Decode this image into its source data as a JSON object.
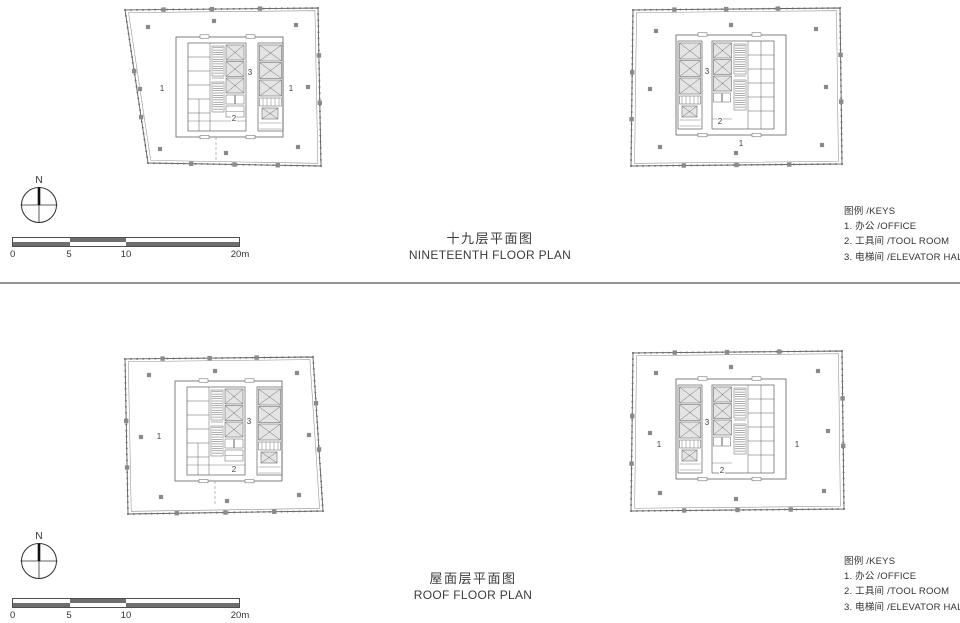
{
  "colors": {
    "background": "#ffffff",
    "ink": "#3b3b3b",
    "drawing_line": "#5f5f5f",
    "column_gray": "#8a8a8a",
    "elevator_fill": "#e4e4e4",
    "scale_dark": "#6e6e6e",
    "divider": "#949494"
  },
  "north": {
    "label": "N"
  },
  "scalebar": {
    "labels": [
      "0",
      "5",
      "10",
      "20m"
    ]
  },
  "sections": [
    {
      "name": "nineteenth-floor",
      "title_zh": "十九层平面图",
      "title_en": "NINETEENTH FLOOR PLAN",
      "legend": {
        "header": "图例 /KEYS",
        "items": [
          "1. 办公 /OFFICE",
          "2. 工具间 /TOOL ROOM",
          "3. 电梯间 /ELEVATOR HALL"
        ]
      },
      "plans": [
        {
          "name": "nineteenth-floor-plan-left",
          "room_labels": [
            {
              "value": "1",
              "meaning": "office",
              "x": 48,
              "y": 88
            },
            {
              "value": "3",
              "meaning": "elevator-hall",
              "x": 136,
              "y": 72
            },
            {
              "value": "1",
              "meaning": "office",
              "x": 177,
              "y": 88
            },
            {
              "value": "2",
              "meaning": "tool-room",
              "x": 120,
              "y": 118
            }
          ]
        },
        {
          "name": "nineteenth-floor-plan-right",
          "room_labels": [
            {
              "value": "3",
              "meaning": "elevator-hall",
              "x": 81,
              "y": 69
            },
            {
              "value": "2",
              "meaning": "tool-room",
              "x": 94,
              "y": 119
            },
            {
              "value": "1",
              "meaning": "office",
              "x": 115,
              "y": 141
            }
          ]
        }
      ]
    },
    {
      "name": "roof-floor",
      "title_zh": "屋面层平面图",
      "title_en": "ROOF FLOOR PLAN",
      "legend": {
        "header": "图例 /KEYS",
        "items": [
          "1. 办公 /OFFICE",
          "2. 工具间 /TOOL ROOM",
          "3. 电梯间 /ELEVATOR HALL"
        ]
      },
      "plans": [
        {
          "name": "roof-floor-plan-left",
          "room_labels": [
            {
              "value": "1",
              "meaning": "office",
              "x": 46,
              "y": 92
            },
            {
              "value": "3",
              "meaning": "elevator-hall",
              "x": 136,
              "y": 77
            },
            {
              "value": "2",
              "meaning": "tool-room",
              "x": 121,
              "y": 125
            }
          ]
        },
        {
          "name": "roof-floor-plan-right",
          "room_labels": [
            {
              "value": "1",
              "meaning": "office",
              "x": 33,
              "y": 98
            },
            {
              "value": "3",
              "meaning": "elevator-hall",
              "x": 81,
              "y": 76
            },
            {
              "value": "2",
              "meaning": "tool-room",
              "x": 96,
              "y": 124
            },
            {
              "value": "1",
              "meaning": "office",
              "x": 171,
              "y": 98
            }
          ]
        }
      ]
    }
  ]
}
